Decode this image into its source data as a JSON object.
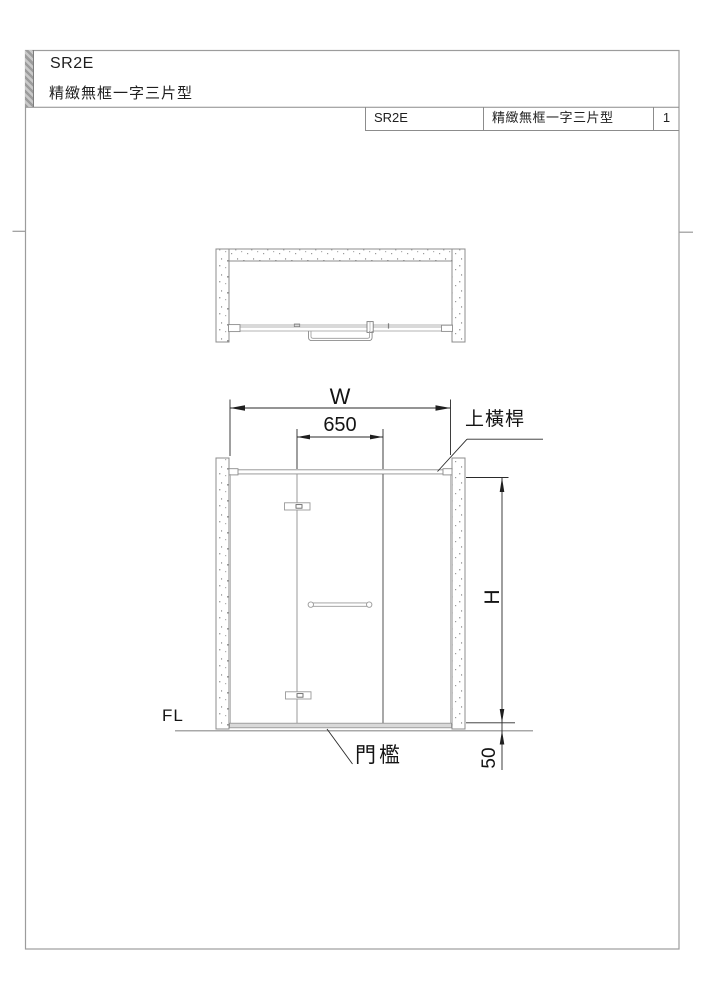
{
  "title_block": {
    "model": "SR2E",
    "name": "精緻無框一字三片型"
  },
  "header_table": {
    "model": "SR2E",
    "name": "精緻無框一字三片型",
    "sheet_number": "1"
  },
  "drawing": {
    "type": "shower-door-technical-drawing",
    "views": [
      "plan-view",
      "front-elevation"
    ],
    "labels": {
      "overall_width": "W",
      "door_opening": "650",
      "top_bar": "上橫桿",
      "height": "H",
      "sill": "門檻",
      "sill_height": "50",
      "floor_level": "FL"
    },
    "colors": {
      "line_gray": "#8c8c8c",
      "dimension_dark": "#1f1f1f",
      "sill_fill": "#d9d9d9",
      "border_gray": "#9c9c9c"
    }
  }
}
